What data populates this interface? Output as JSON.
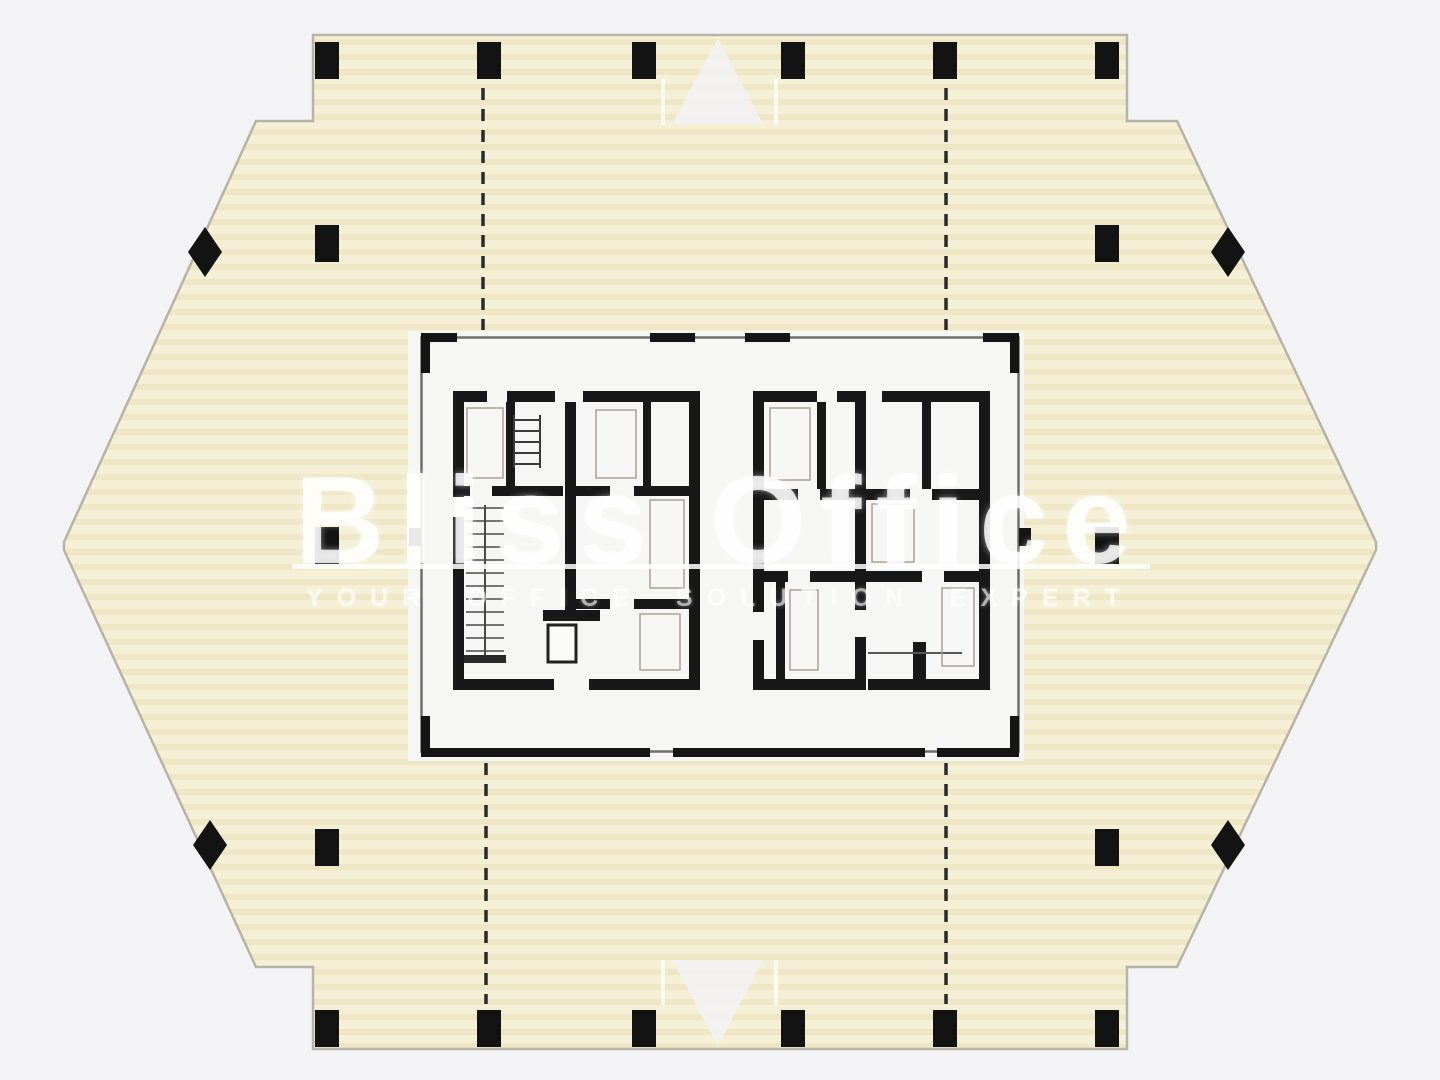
{
  "watermark": {
    "brand": "Bliss Office",
    "tagline": "YOUR OFFICE SOLUTION EXPERT"
  },
  "colors": {
    "background": "#f3f3f5",
    "slab": "#f5efd5",
    "slab_stripe": "#e9ddb8",
    "slab_outline": "#b7b3a8",
    "core_panel": "#f6f6f4",
    "frame_gray": "#6e6e69",
    "wall_black": "#181818",
    "marker_black": "#131313",
    "watermark_white": "#ffffff"
  },
  "plan": {
    "kind": "tower-floor-plan",
    "building_shape": "elongated-hexagon",
    "perimeter_columns": 18,
    "axis_diamonds": 4,
    "dashed_axes": 4,
    "core_blocks": 2
  }
}
